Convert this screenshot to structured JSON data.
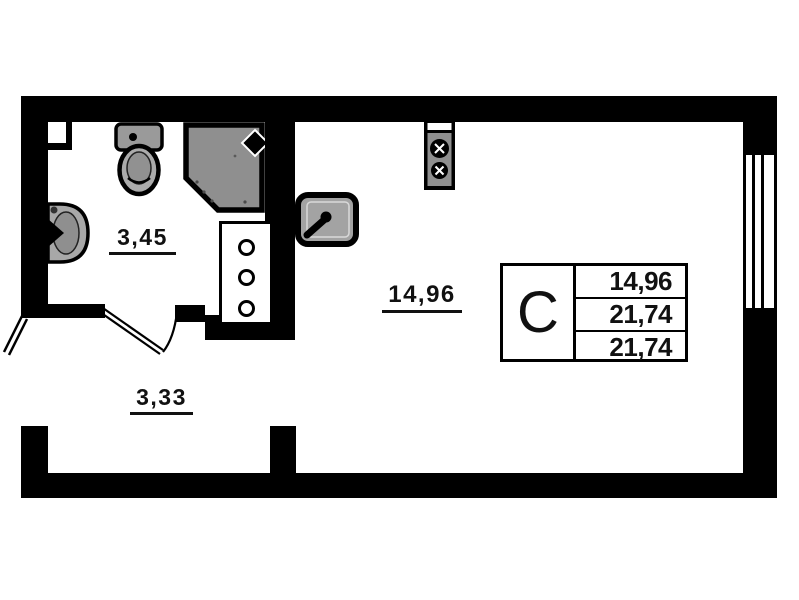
{
  "plan": {
    "title": "studio-apartment-floor-plan",
    "rooms": [
      {
        "name": "bathroom",
        "area": "3,45"
      },
      {
        "name": "hallway",
        "area": "3,33"
      },
      {
        "name": "living-kitchen",
        "area": "14,96"
      }
    ],
    "info_table": {
      "type_label": "С",
      "rows": [
        "14,96",
        "21,74",
        "21,74"
      ]
    },
    "fixtures": [
      "toilet",
      "bathroom-sink",
      "shower-cabin",
      "utility-shaft-cabinet",
      "kitchen-sink",
      "stove-2-burner",
      "bathroom-door-swing",
      "entrance-door",
      "window"
    ],
    "colors": {
      "wall": "#000000",
      "fixture_gray": "#8f8f8f",
      "background": "#ffffff"
    }
  }
}
